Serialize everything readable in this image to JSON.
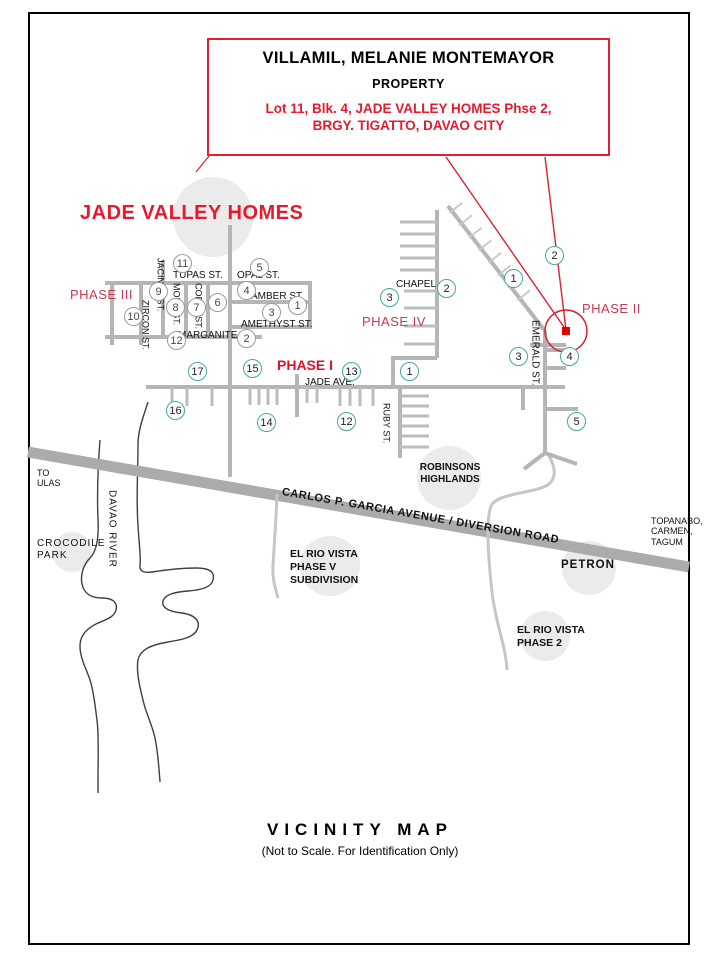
{
  "callout": {
    "owner": "VILLAMIL, MELANIE MONTEMAYOR",
    "property_word": "PROPERTY",
    "address_line1": "Lot 11, Blk. 4, JADE VALLEY HOMES Phse 2,",
    "address_line2": "BRGY. TIGATTO, DAVAO CITY"
  },
  "map": {
    "subdivision_title": "JADE VALLEY HOMES",
    "phase_labels": {
      "phase1": "PHASE I",
      "phase2": "PHASE II",
      "phase3": "PHASE III",
      "phase4": "PHASE IV"
    },
    "streets": {
      "tupas": "TUPAS ST.",
      "opal": "OPAL ST.",
      "amber": "AMBER ST.",
      "amethyst": "AMETHYST ST.",
      "marganite": "MARGANITE",
      "zircon": "ZIRCON ST.",
      "jacinth": "JACINTH ST.",
      "mory": "MORY ST.",
      "coral": "CORAL ST.",
      "jade": "JADE AVE.",
      "ruby": "RUBY ST.",
      "emerald": "EMERALD ST.",
      "chapel": "CHAPEL",
      "diversion": "CARLOS  P.  GARCIA  AVENUE / DIVERSION  ROAD"
    },
    "landmarks": {
      "to_ulas": "TO\nULAS",
      "davao_river": "DAVAO RIVER",
      "crocodile_park": "CROCODILE\nPARK",
      "robinsons": "ROBINSONS\nHIGHLANDS",
      "el_rio_v": "EL RIO VISTA\nPHASE V\nSUBDIVISION",
      "petron": "PETRON",
      "el_rio_2": "EL RIO VISTA\nPHASE 2",
      "topanabo": "TOPANABO,\nCARMEN,\nTAGUM"
    },
    "block_numbers_gray": [
      "11",
      "5",
      "9",
      "4",
      "10",
      "8",
      "7",
      "6",
      "3",
      "1",
      "2",
      "12"
    ],
    "block_numbers_teal": [
      "3",
      "2",
      "1",
      "1",
      "2",
      "3",
      "4",
      "5",
      "17",
      "15",
      "13",
      "16",
      "14",
      "12"
    ]
  },
  "footer": {
    "title": "VICINITY MAP",
    "subtitle": "(Not to Scale. For Identification Only)"
  },
  "colors": {
    "accent_red": "#e02030",
    "title_red": "#e8192c",
    "phase_red": "#c73a52",
    "teal_circle": "#45a5aa",
    "road_gray": "#b5b5b5",
    "highway_gray": "#ababab"
  }
}
